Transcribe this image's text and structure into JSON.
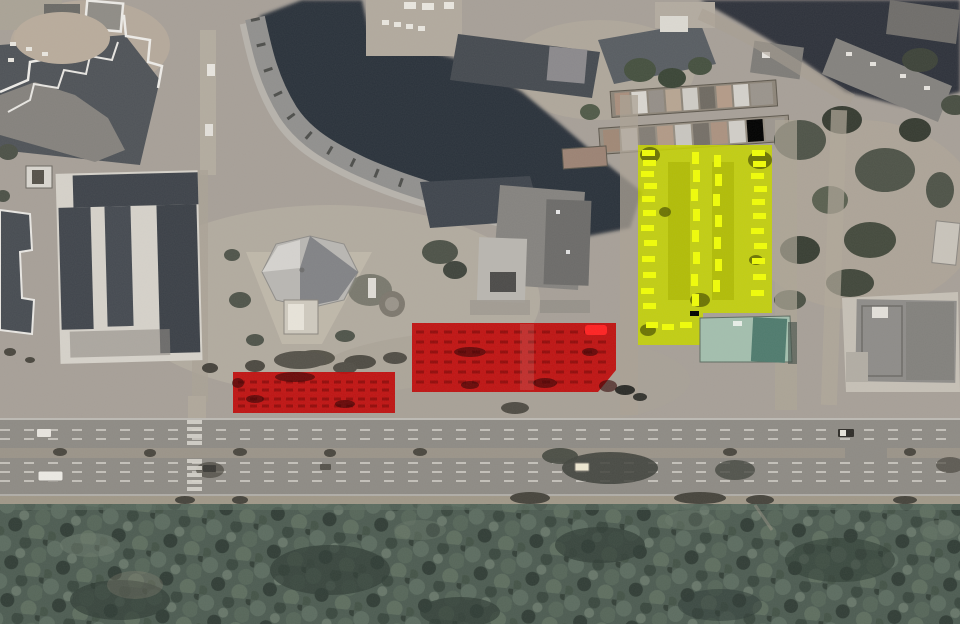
{
  "scene": {
    "type": "annotated-satellite-image",
    "overlays": {
      "red_zone_left": {
        "label": "red-highlight-rectangle-left",
        "color": "#c10808"
      },
      "red_zone_right": {
        "label": "red-highlight-rectangle-right",
        "color": "#c10808"
      },
      "red_marker": {
        "label": "bright-red-marker",
        "color": "#ff2222"
      },
      "yellow_zone": {
        "label": "yellow-highlight-parking-lot",
        "color": "#c6d400"
      }
    },
    "palette": {
      "ground": "#a7a098",
      "ground_light": "#b7afa2",
      "road": "#8e8b85",
      "median": "#9b9489",
      "forest": "#4d5c52",
      "shadow": "#2a313b",
      "building_light": "#d6d2ca",
      "building_dark": "#40454c",
      "building_gray": "#91908e",
      "tree": "#4d5248",
      "green_roof": "#a3bfae",
      "green_roof_dark": "#4f7b6e",
      "lane_marking": "#d5d2cb",
      "car_highlight": "#f0fd08"
    }
  }
}
